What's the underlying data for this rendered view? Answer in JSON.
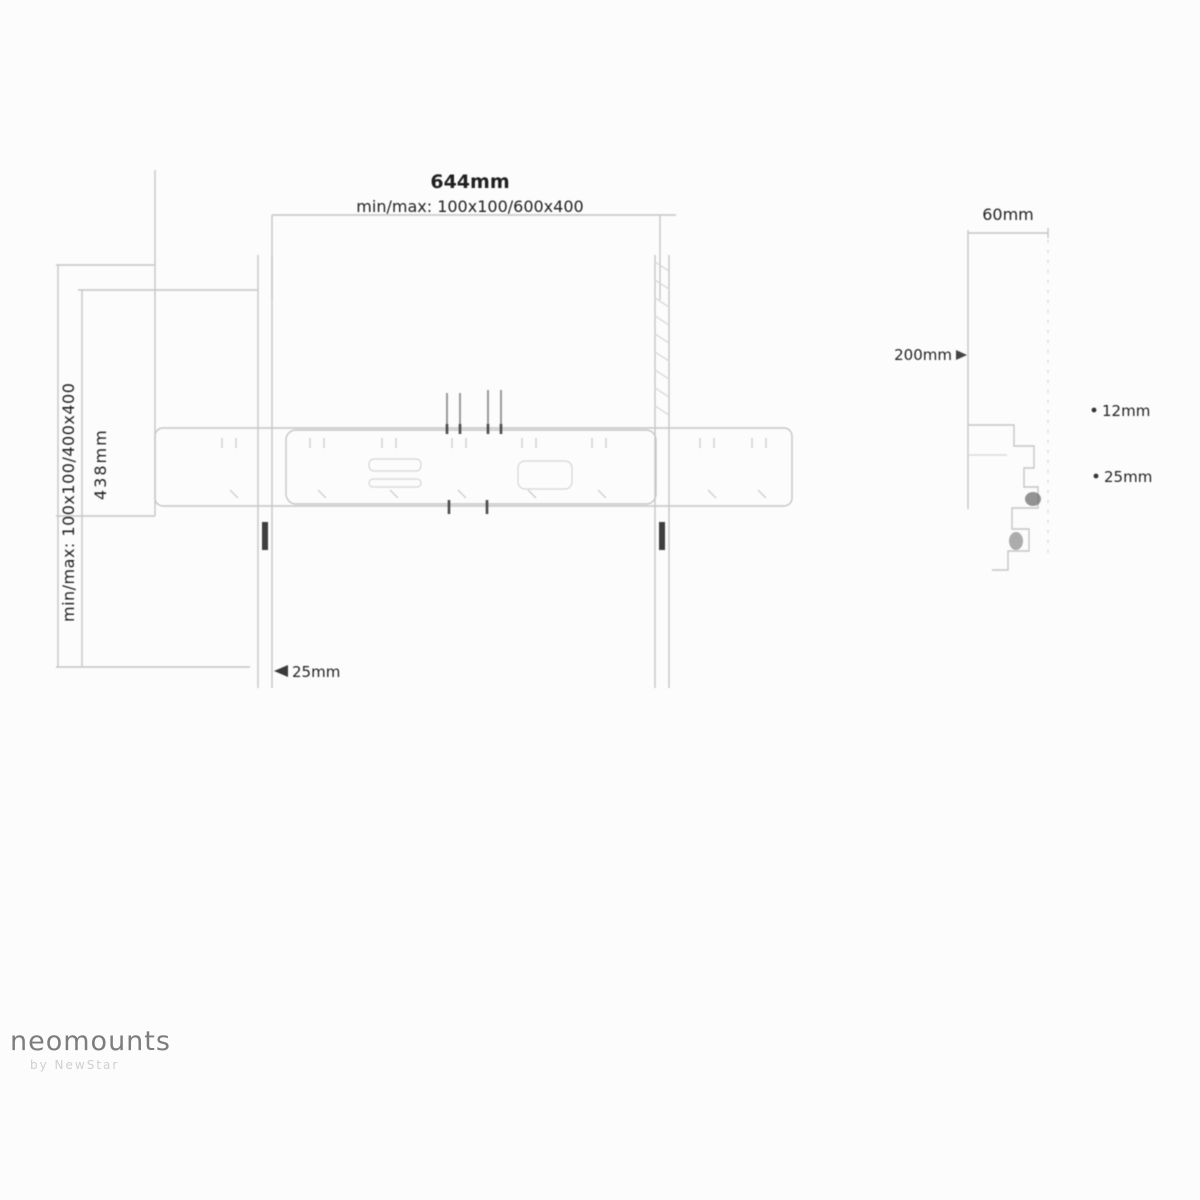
{
  "brand": {
    "name": "neomounts",
    "tagline": "by NewStar"
  },
  "labels": {
    "front": {
      "overall_width": "644mm",
      "vesa_horizontal_range": "min/max: 100x100/600x400",
      "vesa_vertical_range": "min/max: 100x100/400x400",
      "overall_height": "438mm",
      "rail_thickness": "25mm"
    },
    "side": {
      "depth": "60mm",
      "wall_offset": "200mm",
      "hook_gap_upper": "12mm",
      "hook_gap_lower": "25mm"
    }
  },
  "colors": {
    "background": "#fcfcfc",
    "line": "#c6c6c6",
    "dark_mark": "#4a4a4a",
    "label": "#1f1f1f",
    "brand_gray": "#7d7d7d"
  }
}
